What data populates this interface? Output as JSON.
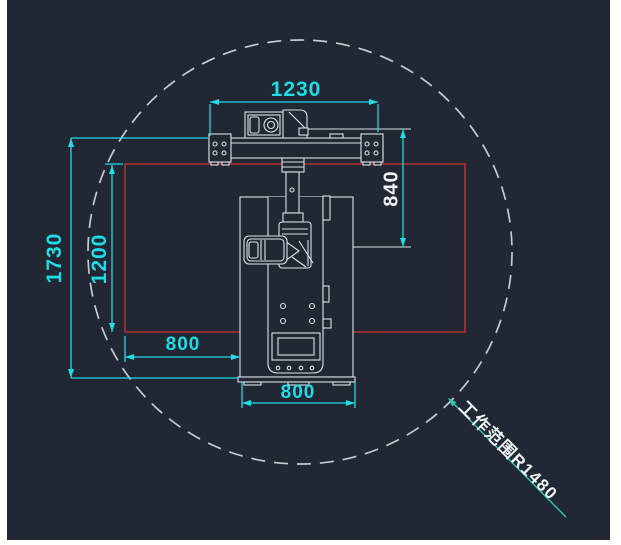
{
  "colors": {
    "page_bg": "#ffffff",
    "canvas_bg": "#212834",
    "dim_cyan": "#1fdce6",
    "machine_white": "#dde2e6",
    "zone_red": "#ac3138",
    "circle_gray": "#c5cbd3",
    "leader_teal": "#2fc8b2",
    "text_white": "#f0f3f5"
  },
  "dimensions": {
    "gantry_width": "1230",
    "arm_drop": "840",
    "work_zone_height": "1200",
    "overall_height": "1730",
    "work_zone_side_width": "800",
    "base_width": "800"
  },
  "labels": {
    "work_range": "工作范围R1480"
  }
}
